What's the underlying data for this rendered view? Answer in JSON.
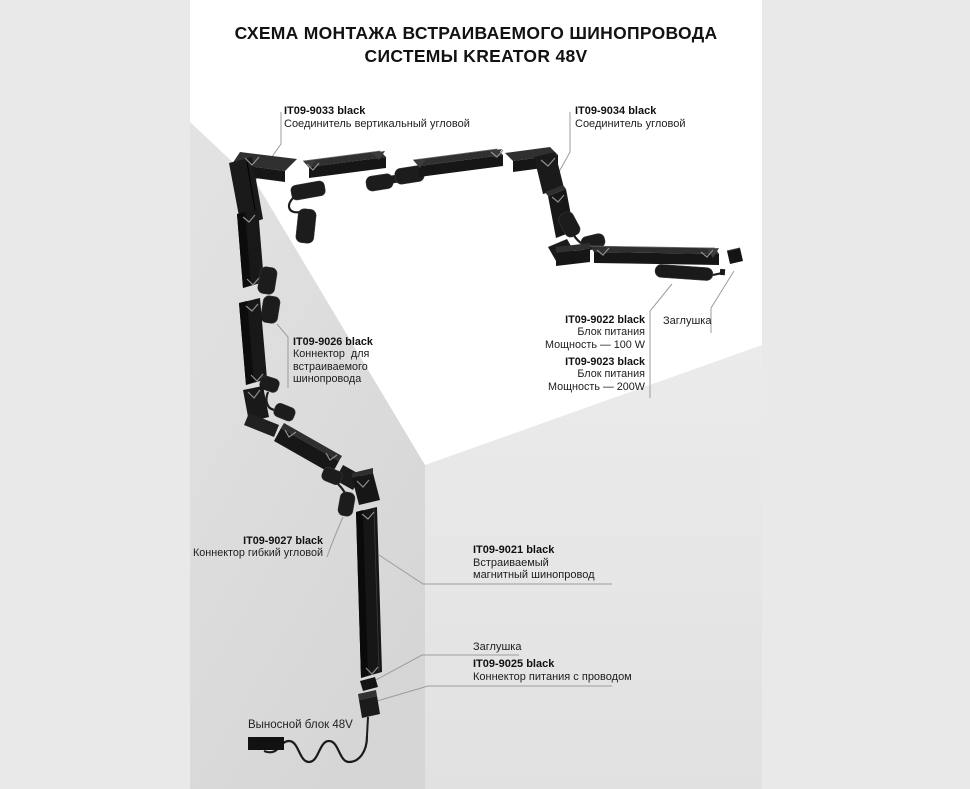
{
  "title": {
    "line1": "СХЕМА МОНТАЖА ВСТРАИВАЕМОГО ШИНОПРОВОДА",
    "line2": "СИСТЕМЫ KREATOR 48V"
  },
  "parts": {
    "it09_9033": {
      "code": "IT09-9033 black",
      "desc": "Соединитель вертикальный угловой"
    },
    "it09_9034": {
      "code": "IT09-9034 black",
      "desc": "Соединитель угловой"
    },
    "it09_9026": {
      "code": "IT09-9026 black",
      "desc1": "Коннектор  для",
      "desc2": "встраиваемого",
      "desc3": "шинопровода"
    },
    "it09_9022": {
      "code": "IT09-9022 black",
      "desc1": "Блок питания",
      "desc2": "Мощность — 100 W"
    },
    "it09_9023": {
      "code": "IT09-9023 black",
      "desc1": "Блок питания",
      "desc2": "Мощность — 200W"
    },
    "plug_right": {
      "label": "Заглушка"
    },
    "it09_9027": {
      "code": "IT09-9027 black",
      "desc": "Коннектор гибкий угловой"
    },
    "it09_9021": {
      "code": "IT09-9021 black",
      "desc1": "Встраиваемый",
      "desc2": "магнитный шинопровод"
    },
    "plug_bottom": {
      "label": "Заглушка"
    },
    "it09_9025": {
      "code": "IT09-9025 black",
      "desc": "Коннектор питания с проводом"
    },
    "remote_block": {
      "label": "Выносной блок 48V"
    }
  },
  "colors": {
    "page_bg": "#e9e9e9",
    "stage_bg": "#ffffff",
    "wall_left": "#dcdcdc",
    "wall_right": "#e6e6e6",
    "track_black": "#161616",
    "label_text": "#1d1d1d",
    "leader_line": "#9c9c9c"
  }
}
